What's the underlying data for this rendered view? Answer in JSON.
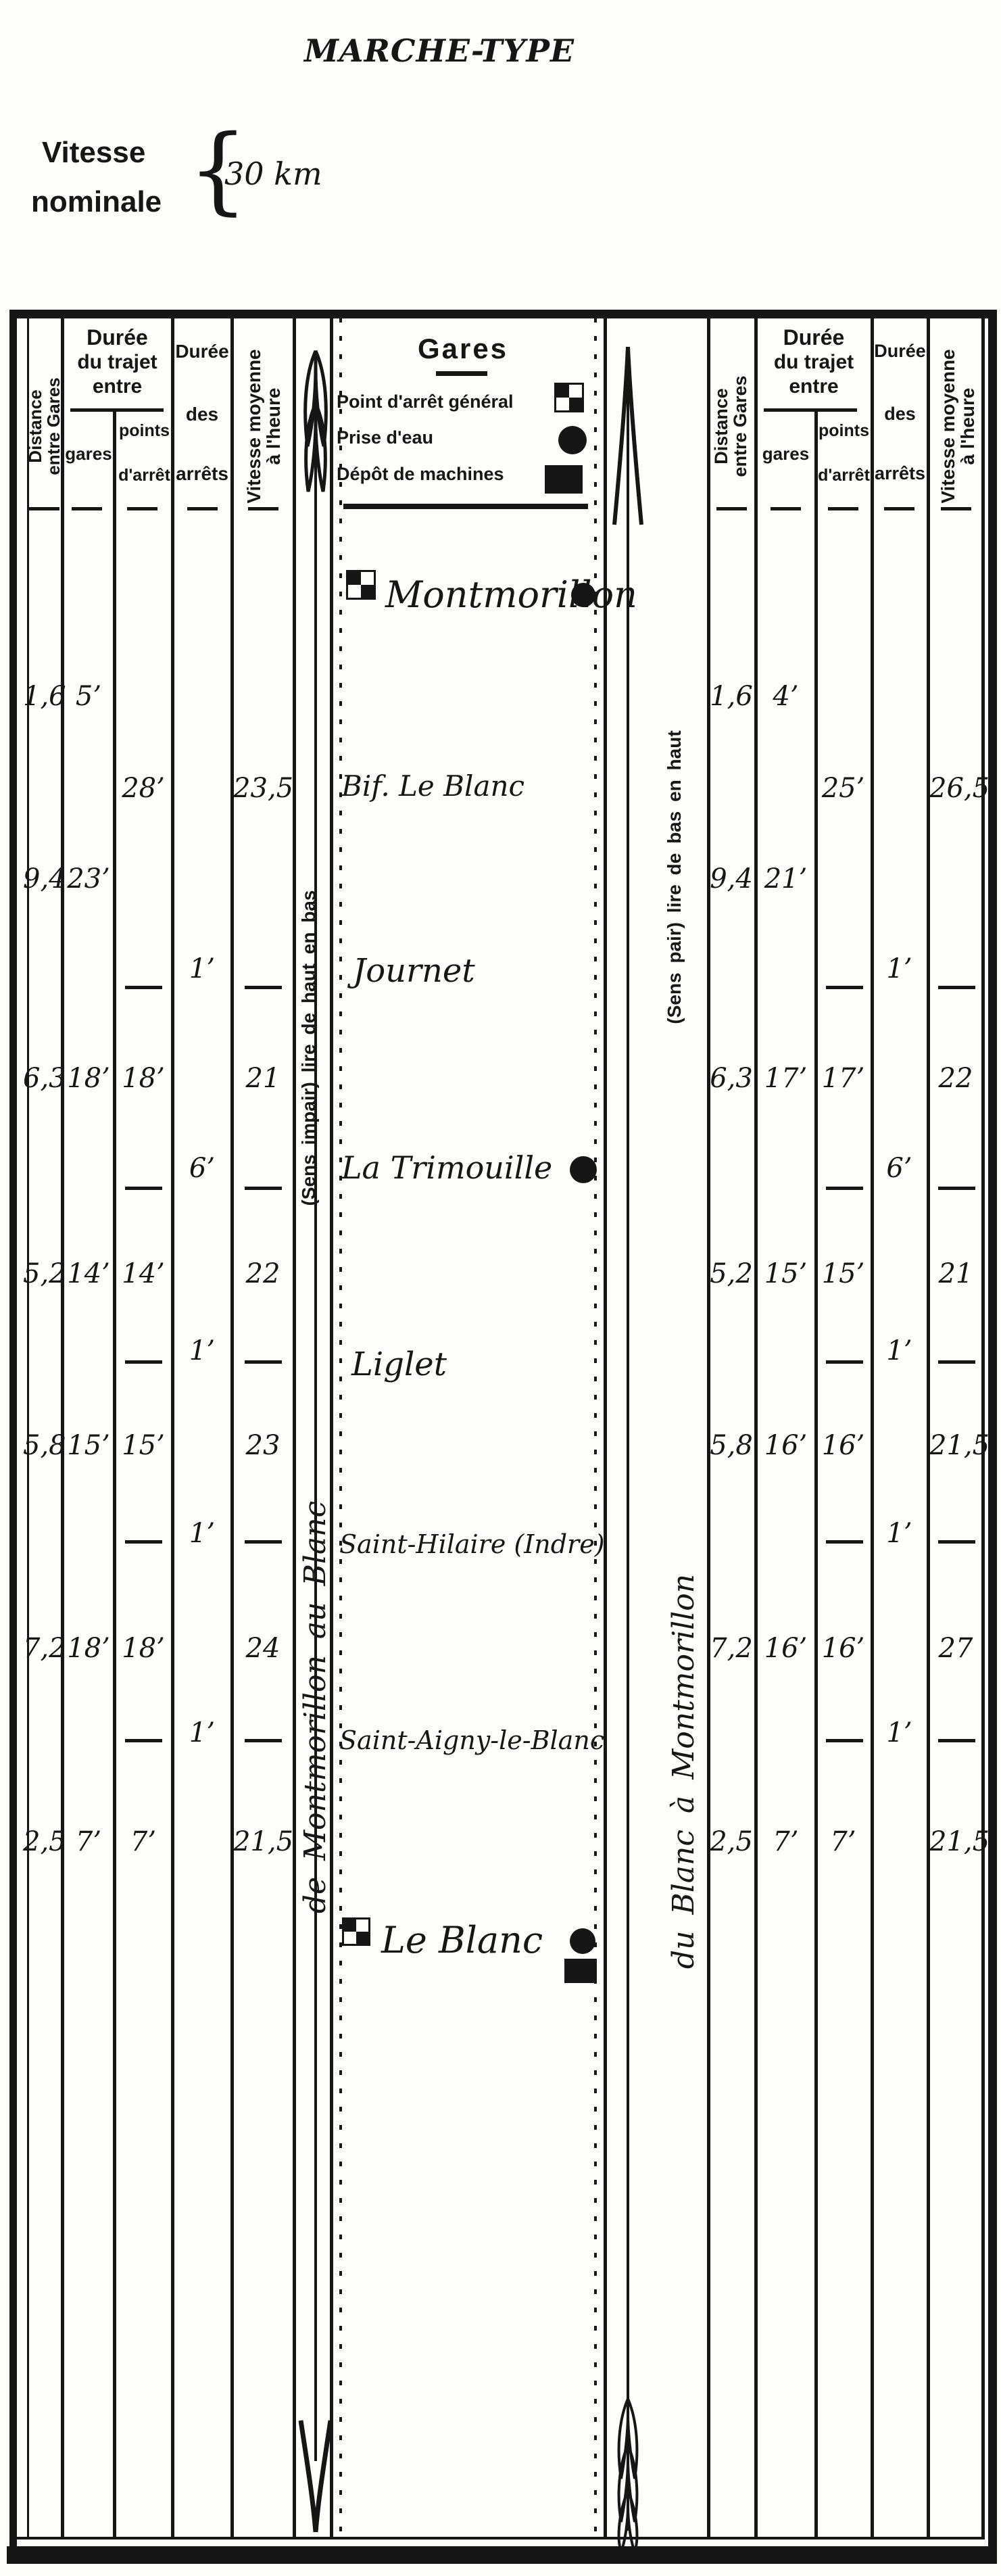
{
  "title": "MARCHE-TYPE",
  "vitesse_nominale": {
    "line1": "Vitesse",
    "line2": "nominale",
    "brace": "{",
    "value": "30 km"
  },
  "headers": {
    "distance_line1": "Distance",
    "distance_line2": "entre Gares",
    "duree_trajet_line1": "Durée",
    "duree_trajet_line2": "du trajet",
    "duree_trajet_line3": "entre",
    "sub_gares": "gares",
    "sub_points_line1": "points",
    "sub_points_line2": "d'arrêt",
    "duree_arrets_line1": "Durée",
    "duree_arrets_line2": "des",
    "duree_arrets_line3": "arrêts",
    "vitesse_line1": "Vitesse moyenne",
    "vitesse_line2": "à l'heure",
    "gares_title": "Gares"
  },
  "legend": {
    "point_arret": "Point d'arrêt général",
    "prise_eau": "Prise d'eau",
    "depot": "Dépôt de machines"
  },
  "directions": {
    "impair_sens": "(Sens impair) lire de haut en bas",
    "impair_route": "de Montmorillon au Blanc",
    "pair_sens": "(Sens pair) lire de bas en haut",
    "pair_route": "du Blanc à Montmorillon"
  },
  "stations": {
    "s0": "Montmorillon",
    "s1": "Bif. Le Blanc",
    "s2": "Journet",
    "s3": "La Trimouille",
    "s4": "Liglet",
    "s5": "Saint-Hilaire (Indre)",
    "s6": "Saint-Aigny-le-Blanc",
    "s7": "Le Blanc"
  },
  "rows": {
    "r1": {
      "left": {
        "dist": "1,6",
        "gares": "5’"
      },
      "right": {
        "dist": "1,6",
        "gares": "4’"
      }
    },
    "r2": {
      "left": {
        "points": "28’",
        "vit": "23,5"
      },
      "right": {
        "points": "25’",
        "vit": "26,5"
      }
    },
    "r3": {
      "left": {
        "dist": "9,4",
        "gares": "23’"
      },
      "right": {
        "dist": "9,4",
        "gares": "21’"
      }
    },
    "r4": {
      "left": {
        "arret": "1’"
      },
      "right": {
        "arret": "1’"
      }
    },
    "r5": {
      "left": {
        "dist": "6,3",
        "gares": "18’",
        "points": "18’",
        "vit": "21"
      },
      "right": {
        "dist": "6,3",
        "gares": "17’",
        "points": "17’",
        "vit": "22"
      }
    },
    "r6": {
      "left": {
        "arret": "6’"
      },
      "right": {
        "arret": "6’"
      }
    },
    "r7": {
      "left": {
        "dist": "5,2",
        "gares": "14’",
        "points": "14’",
        "vit": "22"
      },
      "right": {
        "dist": "5,2",
        "gares": "15’",
        "points": "15’",
        "vit": "21"
      }
    },
    "r8": {
      "left": {
        "arret": "1’"
      },
      "right": {
        "arret": "1’"
      }
    },
    "r9": {
      "left": {
        "dist": "5,8",
        "gares": "15’",
        "points": "15’",
        "vit": "23"
      },
      "right": {
        "dist": "5,8",
        "gares": "16’",
        "points": "16’",
        "vit": "21,5"
      }
    },
    "r10": {
      "left": {
        "arret": "1’"
      },
      "right": {
        "arret": "1’"
      }
    },
    "r11": {
      "left": {
        "dist": "7,2",
        "gares": "18’",
        "points": "18’",
        "vit": "24"
      },
      "right": {
        "dist": "7,2",
        "gares": "16’",
        "points": "16’",
        "vit": "27"
      }
    },
    "r12": {
      "left": {
        "arret": "1’"
      },
      "right": {
        "arret": "1’"
      }
    },
    "r13": {
      "left": {
        "dist": "2,5",
        "gares": "7’",
        "points": "7’",
        "vit": "21,5"
      },
      "right": {
        "dist": "2,5",
        "gares": "7’",
        "points": "7’",
        "vit": "21,5"
      }
    }
  }
}
